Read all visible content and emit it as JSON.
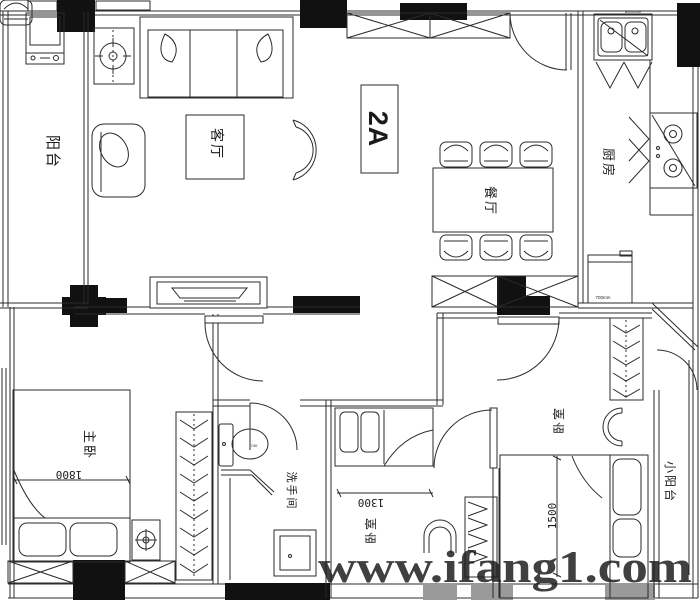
{
  "floor_plan": {
    "unit_label": "2A",
    "watermark_text": "www.ifang1.com",
    "rooms": {
      "balcony": {
        "label": "阳台"
      },
      "living_room": {
        "label": "客厅"
      },
      "dining_room": {
        "label": "餐厅"
      },
      "kitchen": {
        "label": "厨房"
      },
      "master_bedroom": {
        "label": "主卧"
      },
      "bathroom": {
        "label": "洗手间"
      },
      "bedroom_middle": {
        "label": "卧室"
      },
      "bedroom_right": {
        "label": "卧室"
      },
      "small_balcony": {
        "label": "小阳台"
      }
    },
    "dimensions": {
      "master_bed_width": "1800",
      "middle_bed_width": "1300",
      "right_bed_width": "1500"
    },
    "equipment_labels": {
      "sink": "800X450",
      "toilet": "740",
      "fridge": "700mm"
    },
    "colors": {
      "wall": "#111111",
      "line": "#2b2b2b",
      "column_gray": "#9a9a9a",
      "watermark": "#c12026",
      "background": "#ffffff"
    }
  }
}
